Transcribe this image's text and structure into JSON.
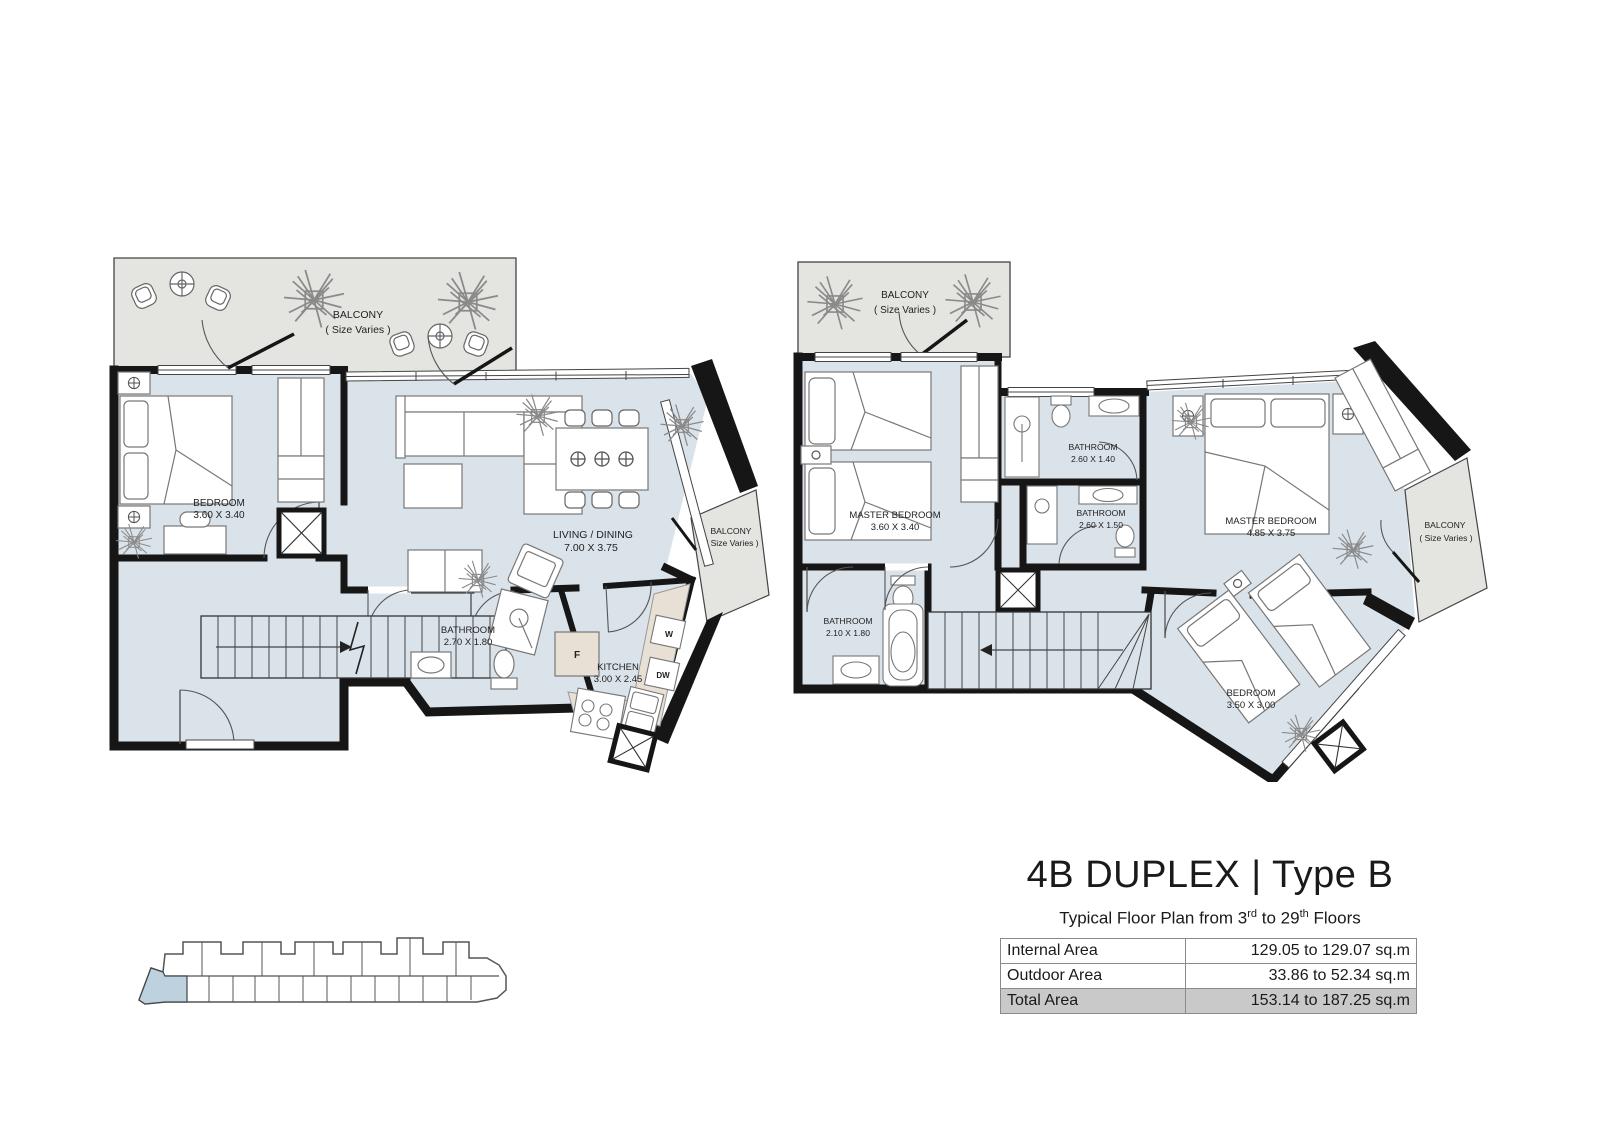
{
  "title_block": {
    "title": "4B DUPLEX | Type B",
    "subtitle": {
      "prefix": "Typical Floor Plan from 3",
      "sup1": "rd",
      "mid": " to 29",
      "sup2": "th",
      "suffix": " Floors"
    },
    "area_table": {
      "rows": [
        {
          "label": "Internal Area",
          "value": "129.05 to 129.07 sq.m"
        },
        {
          "label": "Outdoor Area",
          "value": "33.86 to 52.34 sq.m"
        },
        {
          "label": "Total Area",
          "value": "153.14 to 187.25 sq.m"
        }
      ]
    }
  },
  "lower_floor": {
    "balcony_top": {
      "name": "BALCONY",
      "size": "( Size Varies )"
    },
    "bedroom": {
      "name": "BEDROOM",
      "dims": "3.60 X 3.40"
    },
    "living_dining": {
      "name": "LIVING / DINING",
      "dims": "7.00 X 3.75"
    },
    "balcony_side": {
      "name": "BALCONY",
      "size": "( Size Varies )"
    },
    "bathroom": {
      "name": "BATHROOM",
      "dims": "2.70 X 1.80"
    },
    "kitchen": {
      "name": "KITCHEN",
      "dims": "3.00 X 2.45"
    },
    "appliances": {
      "fridge": "F",
      "washer": "W",
      "dishwasher": "DW"
    }
  },
  "upper_floor": {
    "balcony_top": {
      "name": "BALCONY",
      "size": "( Size Varies )"
    },
    "master_bedroom_small": {
      "name": "MASTER BEDROOM",
      "dims": "3.60 X 3.40"
    },
    "bathroom_1": {
      "name": "BATHROOM",
      "dims": "2.60 X 1.40"
    },
    "bathroom_2": {
      "name": "BATHROOM",
      "dims": "2.60 X 1.50"
    },
    "master_bedroom_large": {
      "name": "MASTER BEDROOM",
      "dims": "4.85 X 3.75"
    },
    "balcony_side": {
      "name": "BALCONY",
      "size": "( Size Varies )"
    },
    "bathroom_3": {
      "name": "BATHROOM",
      "dims": "2.10 X 1.80"
    },
    "bedroom": {
      "name": "BEDROOM",
      "dims": "3.50 X 3.00"
    }
  },
  "colors": {
    "interior": "#dbe3ea",
    "balcony": "#e4e4e1",
    "counter": "#e8e0d5",
    "wall": "#161616",
    "table_border": "#8a8a8a",
    "total_row_bg": "#c9c9c9",
    "keyplan_highlight": "#bdd2de"
  }
}
